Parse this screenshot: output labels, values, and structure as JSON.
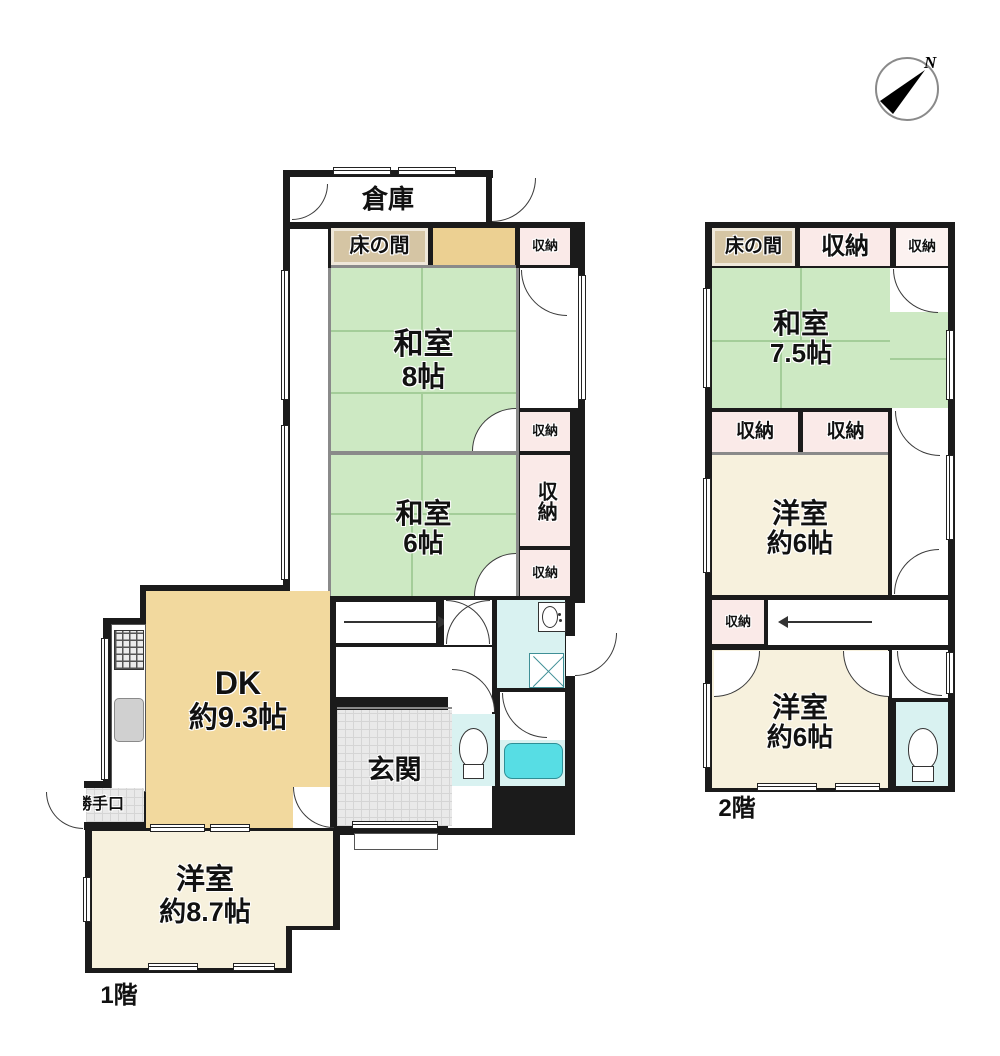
{
  "compass": {
    "north_label": "N"
  },
  "palette": {
    "wall_black": "#1b1b1b",
    "tatami_green": "#cde9c3",
    "dk_tan": "#f2d99e",
    "cream": "#f7f1dd",
    "closet_pink": "#faeae8",
    "tokonoma_tan": "#d5c5a4",
    "oshiire_khaki": "#ecd092",
    "wet_area_cyan": "#d9f2f1",
    "bathtub_cyan": "#57dde4",
    "entry_gray": "#e9e9e9"
  },
  "floor1": {
    "label": "1階",
    "souko": "倉庫",
    "tokonoma": "床の間",
    "storage": "収納",
    "washitsu8": {
      "name": "和室",
      "size": "8帖"
    },
    "washitsu6": {
      "name": "和室",
      "size": "6帖"
    },
    "dk": {
      "name": "DK",
      "size": "約9.3帖"
    },
    "genkan": "玄関",
    "katteguchi": "勝手口",
    "youshitsu87": {
      "name": "洋室",
      "size": "約8.7帖"
    }
  },
  "floor2": {
    "label": "2階",
    "tokonoma": "床の間",
    "storage": "収納",
    "washitsu75": {
      "name": "和室",
      "size": "7.5帖"
    },
    "youshitsu6a": {
      "name": "洋室",
      "size": "約6帖"
    },
    "youshitsu6b": {
      "name": "洋室",
      "size": "約6帖"
    }
  }
}
